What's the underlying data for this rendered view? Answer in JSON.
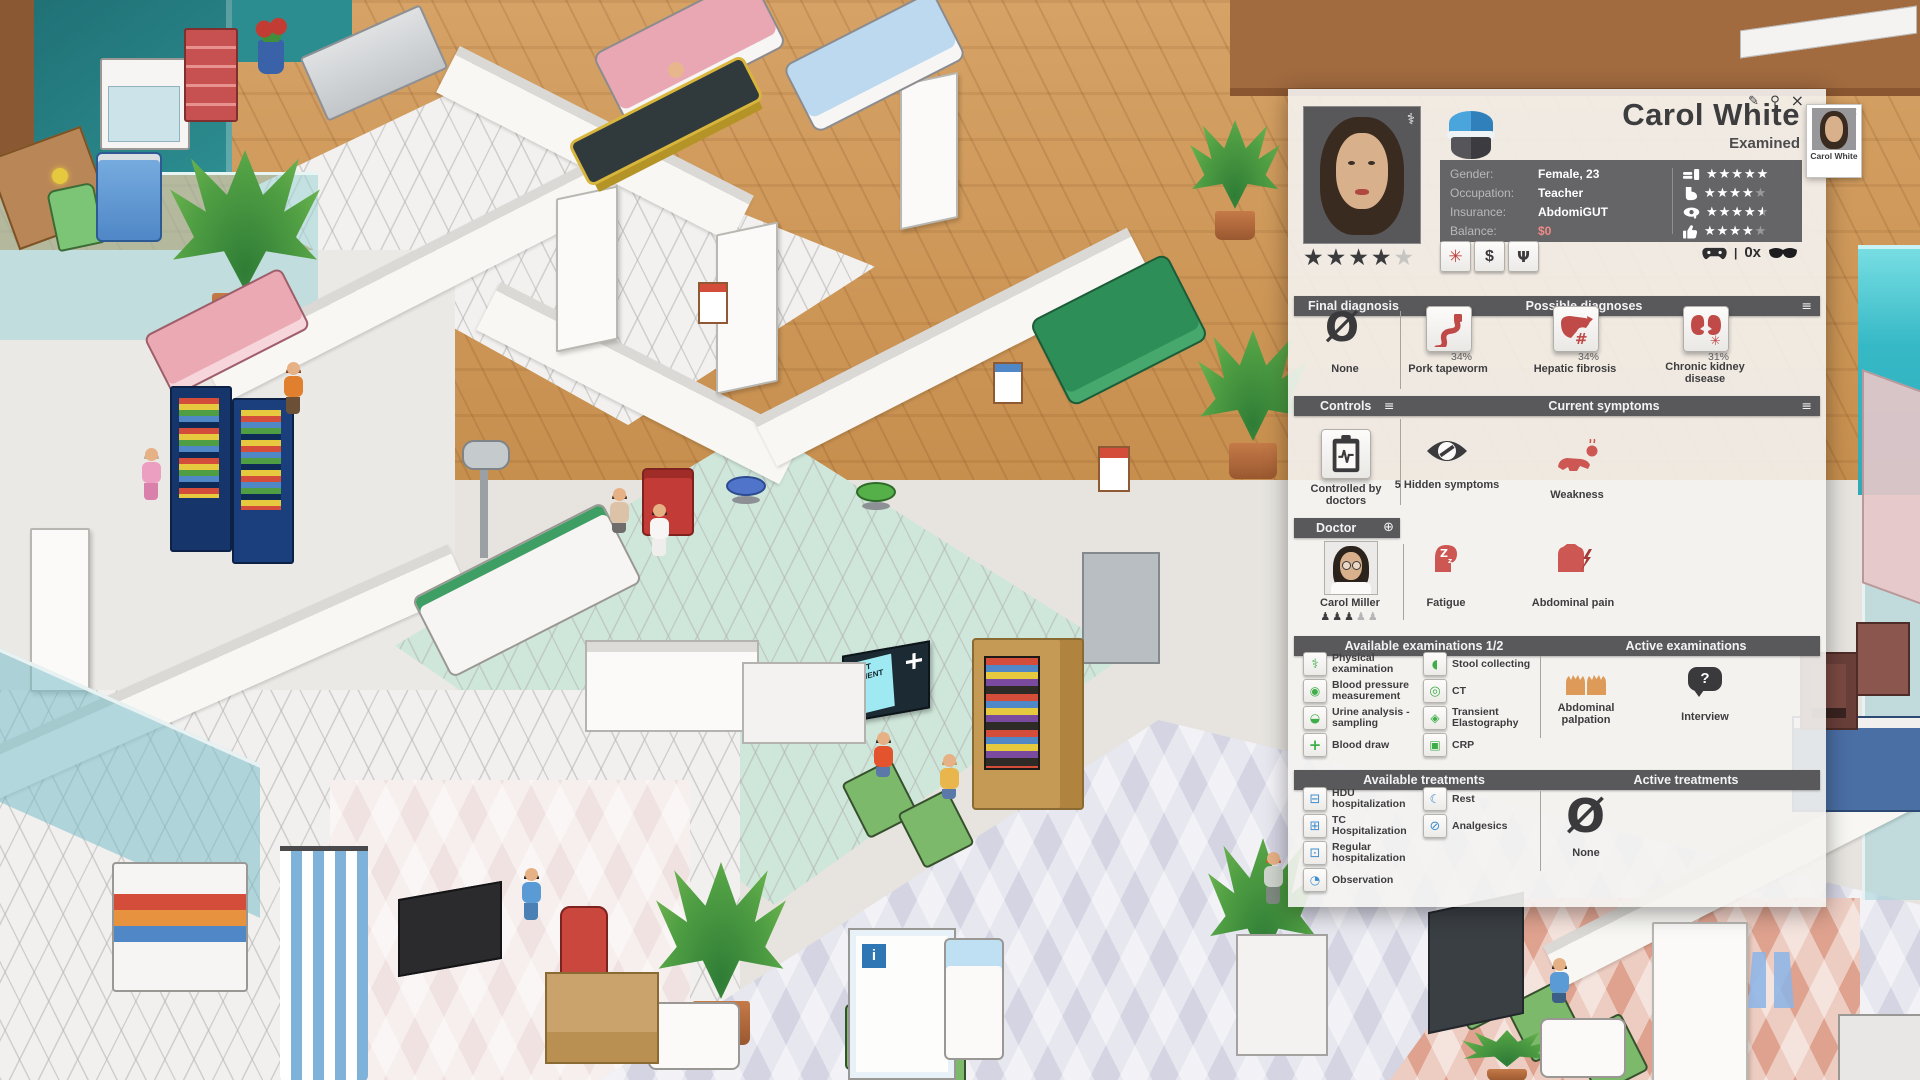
{
  "game": {
    "next_patient_sign": "NEXT PATIENT"
  },
  "icons": {
    "edit-icon": "✎",
    "pin-icon": "⚲",
    "close-icon": "×",
    "list-icon": "≡",
    "caduceus-icon": "⚕",
    "add-doctor-icon": "⊕",
    "none-diagnosis-icon": "Ø",
    "none-treatment-icon": "Ø",
    "emergency-icon": "✳",
    "payment-icon": "$",
    "share-icon": "Ψ",
    "question-icon": "?",
    "physical-examination-icon": "⚕",
    "blood-pressure-icon": "◉",
    "urine-analysis-icon": "◒",
    "blood-draw-icon": "+",
    "stool-collecting-icon": "◖",
    "ct-icon": "◎",
    "elastography-icon": "◈",
    "crp-icon": "▣",
    "hdu-icon": "⊟",
    "tc-icon": "⊞",
    "regular-hospitalization-icon": "⊡",
    "observation-icon": "◔",
    "rest-icon": "☾",
    "analgesics-icon": "⊘",
    "mini-close-icon": "×"
  },
  "panel": {
    "title": "Carol White",
    "status": "Examined",
    "info": {
      "gender_label": "Gender:",
      "gender_value": "Female, 23",
      "occupation_label": "Occupation:",
      "occupation_value": "Teacher",
      "insurance_label": "Insurance:",
      "insurance_value": "AbdomiGUT",
      "balance_label": "Balance:",
      "balance_value": "$0"
    },
    "needs": [
      {
        "name": "hunger",
        "stars": 5
      },
      {
        "name": "toilet",
        "stars": 4
      },
      {
        "name": "pain-tolerance",
        "stars": 4.5
      },
      {
        "name": "mood",
        "stars": 4
      }
    ],
    "patient_rating": {
      "stars": 4,
      "max": 5
    },
    "gamepad_counter": "0x",
    "diagnosis": {
      "final_header": "Final diagnosis",
      "possible_header": "Possible diagnoses",
      "final": {
        "label": "None"
      },
      "possible": [
        {
          "label": "Pork tapeworm",
          "probability": "34%"
        },
        {
          "label": "Hepatic fibrosis",
          "probability": "34%"
        },
        {
          "label": "Chronic kidney disease",
          "probability": "31%"
        }
      ]
    },
    "controls": {
      "header": "Controls",
      "item": "Controlled by doctors"
    },
    "symptoms": {
      "header": "Current symptoms",
      "hidden": {
        "label": "5 Hidden symptoms"
      },
      "items": [
        {
          "label": "Weakness"
        },
        {
          "label": "Fatigue"
        },
        {
          "label": "Abdominal pain"
        }
      ]
    },
    "doctor": {
      "header": "Doctor",
      "name": "Carol Miller",
      "skill": 3,
      "skill_max": 5
    },
    "examinations": {
      "available_header": "Available examinations 1/2",
      "active_header": "Active examinations",
      "available": [
        {
          "label": "Physical examination"
        },
        {
          "label": "Blood pressure measurement"
        },
        {
          "label": "Urine analysis - sampling"
        },
        {
          "label": "Blood draw"
        },
        {
          "label": "Stool collecting"
        },
        {
          "label": "CT"
        },
        {
          "label": "Transient Elastography"
        },
        {
          "label": "CRP"
        }
      ],
      "active": [
        {
          "label": "Abdominal palpation"
        },
        {
          "label": "Interview"
        }
      ]
    },
    "treatments": {
      "available_header": "Available treatments",
      "active_header": "Active treatments",
      "available": [
        {
          "label": "HDU hospitalization"
        },
        {
          "label": "TC Hospitalization"
        },
        {
          "label": "Regular hospitalization"
        },
        {
          "label": "Observation"
        },
        {
          "label": "Rest"
        },
        {
          "label": "Analgesics"
        }
      ],
      "active_none": "None"
    },
    "mini_card": {
      "name": "Carol White"
    }
  },
  "colors": {
    "accent_red": "#bf4a47",
    "exam_green": "#3fae49",
    "treatment_blue": "#3e8ed0",
    "header_bar": "#59595c",
    "balance_red": "#ef8a87",
    "mint_floor": "#cfe7da",
    "lavender_floor": "#d8d8e6"
  }
}
